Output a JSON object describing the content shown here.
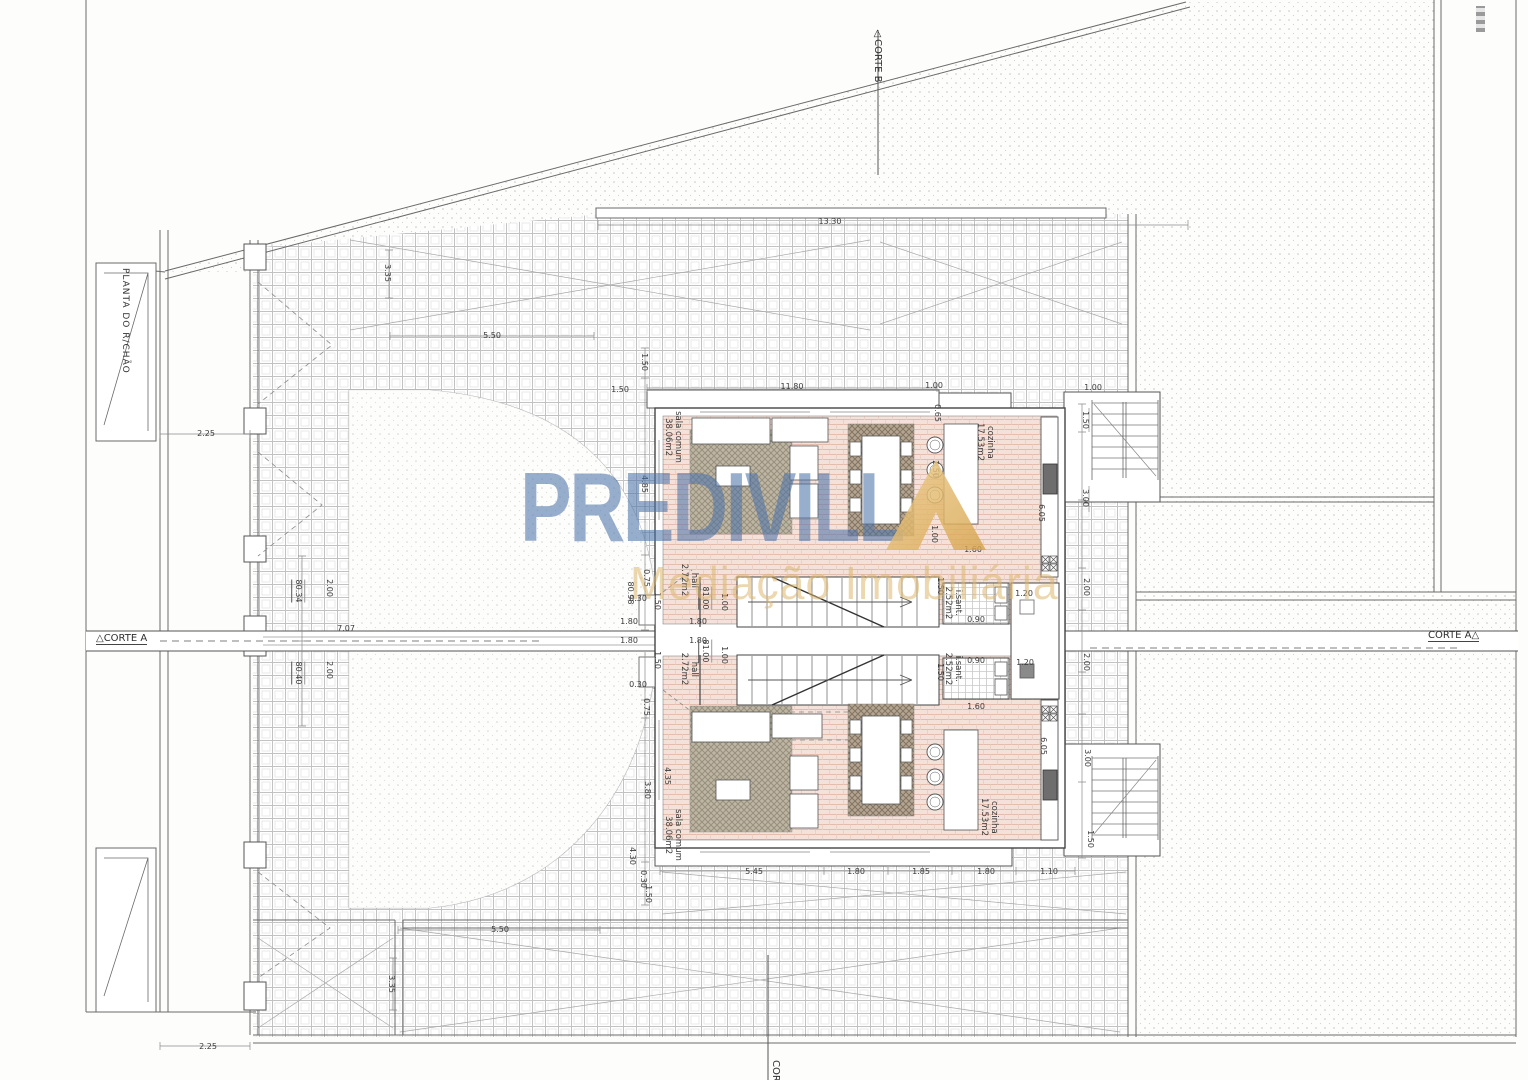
{
  "document": {
    "title": "PLANTA DO R/CHÃO"
  },
  "watermark": {
    "brand_text": "PREDIVILL",
    "brand_last_letter": "A",
    "tagline": "Mediação Imobiliária",
    "brand_color": "#4d74a8",
    "accent_color": "#d9a74e"
  },
  "palette": {
    "paper": "#fdfdfc",
    "line": "#5f5f5f",
    "tile_line": "#c2c2c2",
    "pink_floor": "#f4e1d9",
    "pink_line": "#e3bcae",
    "rug": "#beb6a4",
    "stipple_dot": "#c4c4c4"
  },
  "sections": {
    "corte_a_left": {
      "label": "CORTE A"
    },
    "corte_a_right": {
      "label": "CORTE A"
    },
    "corte_b_top": {
      "label": "CORTE B"
    },
    "corte_b_bottom": {
      "label": "CORTE B"
    }
  },
  "rooms": [
    {
      "name": "sala comum",
      "area": "38.06m2",
      "unit": "upper"
    },
    {
      "name": "cozinha",
      "area": "17.53m2",
      "unit": "upper"
    },
    {
      "name": "hall",
      "area": "2.72m2",
      "unit": "upper"
    },
    {
      "name": "i.sant.",
      "area": "2.52m2",
      "unit": "upper"
    },
    {
      "name": "sala comum",
      "area": "38.06m2",
      "unit": "lower"
    },
    {
      "name": "cozinha",
      "area": "17.53m2",
      "unit": "lower"
    },
    {
      "name": "hall",
      "area": "2.72m2",
      "unit": "lower"
    },
    {
      "name": "i.sant.",
      "area": "2.52m2",
      "unit": "lower"
    }
  ],
  "levels": [
    "80.34",
    "80.40",
    "80.98",
    "81.00",
    "81.00"
  ],
  "annotations": [
    {
      "t": "13.30",
      "x": 830,
      "y": 222,
      "o": "h",
      "k": "dim"
    },
    {
      "t": "3.35",
      "x": 387,
      "y": 273,
      "o": "v",
      "k": "dim"
    },
    {
      "t": "5.50",
      "x": 492,
      "y": 336,
      "o": "h",
      "k": "dim"
    },
    {
      "t": "2.25",
      "x": 206,
      "y": 434,
      "o": "h",
      "k": "dim"
    },
    {
      "t": "1.50",
      "x": 644,
      "y": 362,
      "o": "v",
      "k": "dim"
    },
    {
      "t": "1.50",
      "x": 620,
      "y": 390,
      "o": "h",
      "k": "dim"
    },
    {
      "t": "11.80",
      "x": 792,
      "y": 387,
      "o": "h",
      "k": "dim"
    },
    {
      "t": "1.00",
      "x": 934,
      "y": 386,
      "o": "h",
      "k": "dim"
    },
    {
      "t": "1.00",
      "x": 1093,
      "y": 388,
      "o": "h",
      "k": "dim"
    },
    {
      "t": "0.65",
      "x": 937,
      "y": 413,
      "o": "v",
      "k": "dim"
    },
    {
      "t": "1.50",
      "x": 1085,
      "y": 420,
      "o": "v",
      "k": "dim"
    },
    {
      "t": "4.85",
      "x": 644,
      "y": 484,
      "o": "v",
      "k": "dim"
    },
    {
      "t": "2.50",
      "x": 935,
      "y": 469,
      "o": "v",
      "k": "dim"
    },
    {
      "t": "3.00",
      "x": 1085,
      "y": 498,
      "o": "v",
      "k": "dim"
    },
    {
      "t": "6.05",
      "x": 1041,
      "y": 513,
      "o": "v",
      "k": "dim"
    },
    {
      "t": "1.00",
      "x": 934,
      "y": 534,
      "o": "v",
      "k": "dim"
    },
    {
      "t": "1.60",
      "x": 973,
      "y": 550,
      "o": "h",
      "k": "dim"
    },
    {
      "t": "0.75",
      "x": 646,
      "y": 578,
      "o": "v",
      "k": "dim"
    },
    {
      "t": "1.50",
      "x": 940,
      "y": 586,
      "o": "v",
      "k": "dim"
    },
    {
      "t": "1.20",
      "x": 1024,
      "y": 594,
      "o": "h",
      "k": "dim"
    },
    {
      "t": "2.00",
      "x": 329,
      "y": 588,
      "o": "v",
      "k": "dim"
    },
    {
      "t": "2.00",
      "x": 1086,
      "y": 587,
      "o": "v",
      "k": "dim"
    },
    {
      "t": "80.34",
      "x": 298,
      "y": 591,
      "o": "v",
      "k": "level"
    },
    {
      "t": "80.98",
      "x": 630,
      "y": 593,
      "o": "v",
      "k": "dim"
    },
    {
      "t": "0.30",
      "x": 638,
      "y": 599,
      "o": "h",
      "k": "dim"
    },
    {
      "t": "81.00",
      "x": 705,
      "y": 598,
      "o": "v",
      "k": "level"
    },
    {
      "t": "1.00",
      "x": 724,
      "y": 602,
      "o": "v",
      "k": "dim"
    },
    {
      "t": "1.50",
      "x": 657,
      "y": 601,
      "o": "v",
      "k": "dim"
    },
    {
      "t": "1.80",
      "x": 629,
      "y": 622,
      "o": "h",
      "k": "dim"
    },
    {
      "t": "1.80",
      "x": 698,
      "y": 622,
      "o": "h",
      "k": "dim"
    },
    {
      "t": "0.90",
      "x": 976,
      "y": 620,
      "o": "h",
      "k": "dim"
    },
    {
      "t": "7.07",
      "x": 346,
      "y": 629,
      "o": "h",
      "k": "dim"
    },
    {
      "t": "1.80",
      "x": 629,
      "y": 641,
      "o": "h",
      "k": "dim"
    },
    {
      "t": "1.80",
      "x": 698,
      "y": 641,
      "o": "h",
      "k": "dim"
    },
    {
      "t": "81.00",
      "x": 705,
      "y": 651,
      "o": "v",
      "k": "level"
    },
    {
      "t": "1.00",
      "x": 724,
      "y": 655,
      "o": "v",
      "k": "dim"
    },
    {
      "t": "1.50",
      "x": 657,
      "y": 660,
      "o": "v",
      "k": "dim"
    },
    {
      "t": "0.90",
      "x": 976,
      "y": 661,
      "o": "h",
      "k": "dim"
    },
    {
      "t": "1.20",
      "x": 1025,
      "y": 663,
      "o": "h",
      "k": "dim"
    },
    {
      "t": "2.00",
      "x": 329,
      "y": 670,
      "o": "v",
      "k": "dim"
    },
    {
      "t": "2.00",
      "x": 1086,
      "y": 662,
      "o": "v",
      "k": "dim"
    },
    {
      "t": "80.40",
      "x": 298,
      "y": 673,
      "o": "v",
      "k": "level"
    },
    {
      "t": "1.50",
      "x": 940,
      "y": 672,
      "o": "v",
      "k": "dim"
    },
    {
      "t": "0.30",
      "x": 638,
      "y": 685,
      "o": "h",
      "k": "dim"
    },
    {
      "t": "0.75",
      "x": 646,
      "y": 707,
      "o": "v",
      "k": "dim"
    },
    {
      "t": "1.60",
      "x": 976,
      "y": 707,
      "o": "h",
      "k": "dim"
    },
    {
      "t": "4.35",
      "x": 667,
      "y": 776,
      "o": "v",
      "k": "dim"
    },
    {
      "t": "3.80",
      "x": 647,
      "y": 790,
      "o": "v",
      "k": "dim"
    },
    {
      "t": "6.05",
      "x": 1043,
      "y": 746,
      "o": "v",
      "k": "dim"
    },
    {
      "t": "3.00",
      "x": 1087,
      "y": 758,
      "o": "v",
      "k": "dim"
    },
    {
      "t": "5.45",
      "x": 754,
      "y": 872,
      "o": "h",
      "k": "dim"
    },
    {
      "t": "1.80",
      "x": 856,
      "y": 872,
      "o": "h",
      "k": "dim"
    },
    {
      "t": "1.85",
      "x": 921,
      "y": 872,
      "o": "h",
      "k": "dim"
    },
    {
      "t": "1.80",
      "x": 986,
      "y": 872,
      "o": "h",
      "k": "dim"
    },
    {
      "t": "1.10",
      "x": 1049,
      "y": 872,
      "o": "h",
      "k": "dim"
    },
    {
      "t": "4.30",
      "x": 632,
      "y": 856,
      "o": "v",
      "k": "dim"
    },
    {
      "t": "0.30",
      "x": 643,
      "y": 879,
      "o": "v",
      "k": "dim"
    },
    {
      "t": "1.50",
      "x": 648,
      "y": 894,
      "o": "v",
      "k": "dim"
    },
    {
      "t": "1.50",
      "x": 1090,
      "y": 839,
      "o": "v",
      "k": "dim"
    },
    {
      "t": "5.50",
      "x": 500,
      "y": 930,
      "o": "h",
      "k": "dim"
    },
    {
      "t": "3.35",
      "x": 391,
      "y": 984,
      "o": "v",
      "k": "dim"
    },
    {
      "t": "2.25",
      "x": 208,
      "y": 1047,
      "o": "h",
      "k": "dim"
    },
    {
      "t": "sala comum\n38.06m2",
      "x": 673,
      "y": 437,
      "o": "v",
      "k": "room"
    },
    {
      "t": "cozinha\n17.53m2",
      "x": 985,
      "y": 442,
      "o": "v",
      "k": "room"
    },
    {
      "t": "hall\n2.72m2",
      "x": 689,
      "y": 580,
      "o": "v",
      "k": "room"
    },
    {
      "t": "i.sant.\n2.52m2",
      "x": 953,
      "y": 603,
      "o": "v",
      "k": "room"
    },
    {
      "t": "i.sant.\n2.52m2",
      "x": 953,
      "y": 669,
      "o": "v",
      "k": "room"
    },
    {
      "t": "hall\n2.72m2",
      "x": 689,
      "y": 669,
      "o": "v",
      "k": "room"
    },
    {
      "t": "sala comum\n38.06m2",
      "x": 673,
      "y": 835,
      "o": "v",
      "k": "room"
    },
    {
      "t": "cozinha\n17.53m2",
      "x": 989,
      "y": 817,
      "o": "v",
      "k": "room"
    }
  ]
}
